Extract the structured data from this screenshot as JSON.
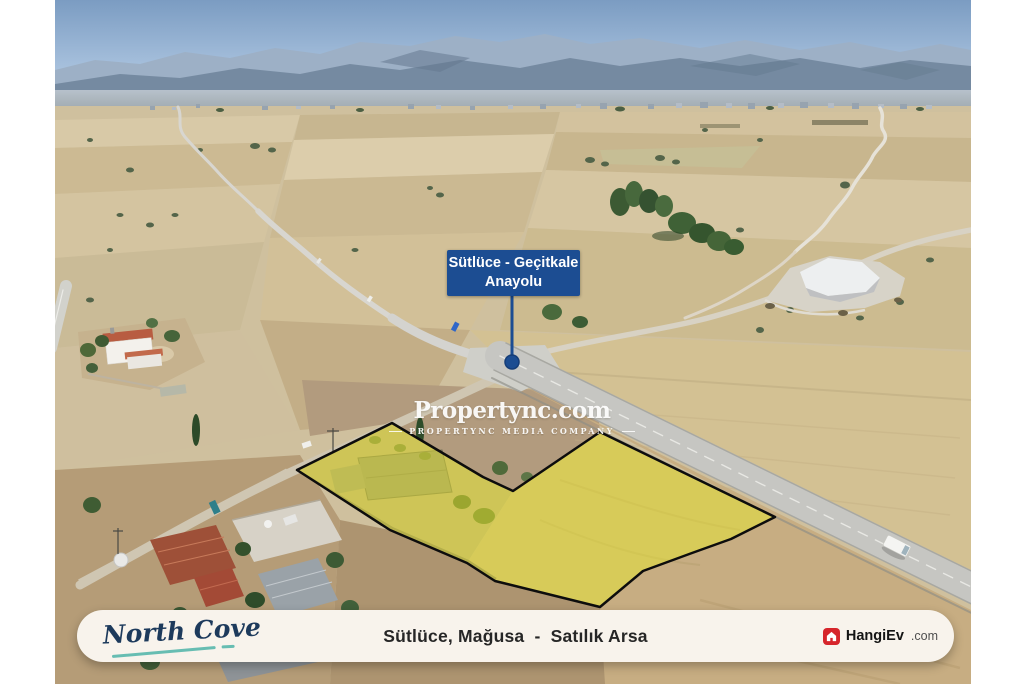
{
  "annotations": {
    "road_label": {
      "line1": "Sütlüce - Geçitkale",
      "line2": "Anayolu",
      "bg": "#1c4d92",
      "text_color": "#ffffff"
    },
    "marker": {
      "color": "#1c4d92"
    },
    "watermark": {
      "brand": "Propertync.com",
      "tagline": "PROPERTYNC MEDIA COMPANY",
      "color": "#ffffff"
    },
    "parcel": {
      "fill": "#e6e42f",
      "fill_opacity": "0.5",
      "stroke": "#0d0d0d"
    }
  },
  "footer": {
    "agency": {
      "name": "North Cove",
      "text_color": "#1d3a5c",
      "underline_color": "#4db3a8"
    },
    "title": "Sütlüce, Mağusa  -  Satılık Arsa",
    "portal": {
      "name": "HangiEv",
      "suffix": ".com",
      "icon": "house-icon",
      "icon_bg": "#d6252b"
    }
  },
  "palette": {
    "frame_white": "#ffffff",
    "footer_cream": "#f8f3ec",
    "label_blue": "#1c4d92",
    "parcel_yellow": "#e6e42f",
    "portal_red": "#d6252b",
    "agency_navy": "#1d3a5c",
    "agency_teal": "#4db3a8"
  }
}
